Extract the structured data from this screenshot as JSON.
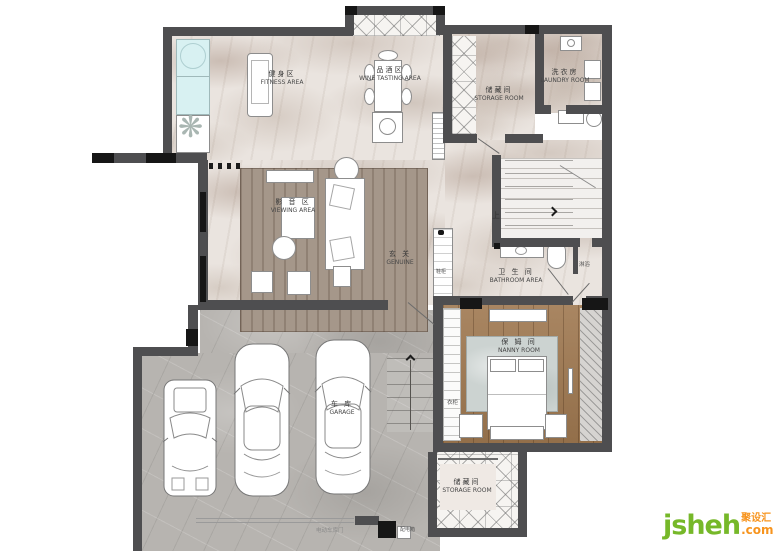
{
  "rooms": {
    "fitness": {
      "zh": "健身区",
      "en": "FITNESS AREA"
    },
    "wine": {
      "zh": "品酒区",
      "en": "WINE TASTING AREA"
    },
    "storage_top": {
      "zh": "储藏间",
      "en": "STORAGE ROOM"
    },
    "laundry": {
      "zh": "洗衣房",
      "en": "LAUNDRY ROOM"
    },
    "viewing": {
      "zh": "影 音 区",
      "en": "VIEWING AREA"
    },
    "entry": {
      "zh": "玄 关",
      "en": "GENUINE"
    },
    "bathroom": {
      "zh": "卫 生 间",
      "en": "BATHROOM AREA"
    },
    "nanny": {
      "zh": "保 姆 间",
      "en": "NANNY ROOM"
    },
    "garage": {
      "zh": "车 库",
      "en": "GARAGE"
    },
    "storage_bottom": {
      "zh": "储藏间",
      "en": "STORAGE ROOM"
    }
  },
  "small_labels": {
    "stairs_up": "上",
    "shower": "淋浴",
    "wardrobe": "衣柜",
    "shoe_cabinet": "鞋柜",
    "garage_door": "电动车库门",
    "power_box": "配电箱"
  },
  "logo": {
    "name": "jsheh",
    "tld": ".com",
    "cn": "聚设汇"
  },
  "colors": {
    "wall": "#4e4e50",
    "black": "#161616",
    "marble": "#eae4df",
    "concrete": "#b7b4b0",
    "wood": "#9f7850",
    "window_cyan": "#d8f1f2",
    "logo_green": "#76b829",
    "logo_orange": "#f7941e"
  }
}
